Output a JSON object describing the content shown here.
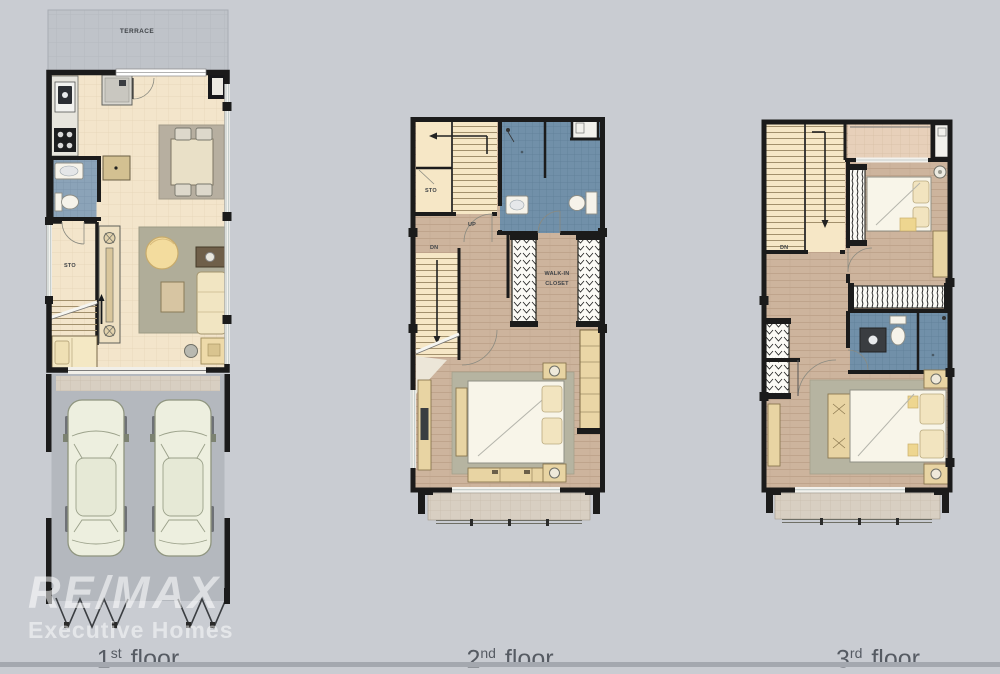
{
  "watermark": {
    "brand": "RE/MAX",
    "tagline": "Executive Homes"
  },
  "floors": [
    {
      "id": "floor1",
      "caption": {
        "num": "1",
        "sup": "st",
        "word": "floor"
      },
      "labels": {
        "terrace": "TERRACE",
        "sto": "STO"
      }
    },
    {
      "id": "floor2",
      "caption": {
        "num": "2",
        "sup": "nd",
        "word": "floor"
      },
      "labels": {
        "sto": "STO",
        "up": "UP",
        "dn": "DN",
        "walkin_1": "WALK-IN",
        "walkin_2": "CLOSET"
      }
    },
    {
      "id": "floor3",
      "caption": {
        "num": "3",
        "sup": "rd",
        "word": "floor"
      },
      "labels": {
        "dn": "DN"
      }
    }
  ],
  "colors": {
    "background": "#c9ccd2",
    "wall": "#1b1b1b",
    "cream_tile_floor": "#f3e5cb",
    "wood_floor": "#cdb49d",
    "bathroom_tile": "#7190a9",
    "garage_floor": "#b4b8be",
    "terrace_floor": "#bfc3c9",
    "rug": "#b6b4a1",
    "furniture_tan": "#e8d4a3",
    "car_body": "#edefdf",
    "watermark_text": "#ffffff",
    "caption_text": "#565b63"
  }
}
